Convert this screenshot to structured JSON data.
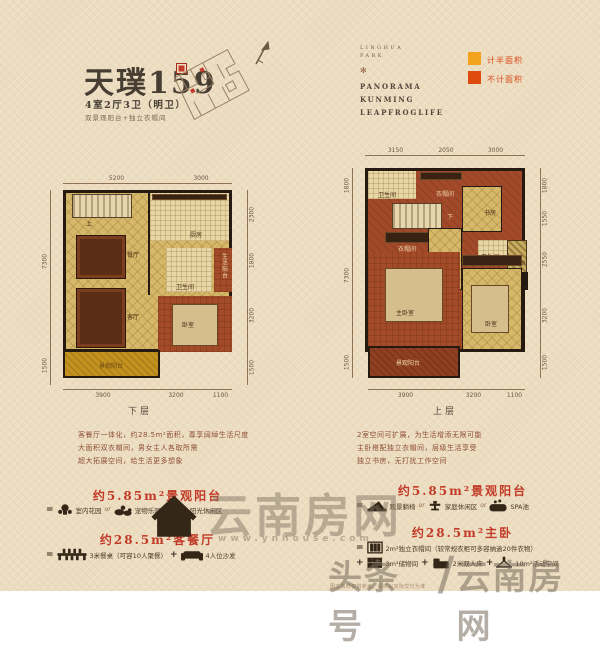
{
  "header": {
    "title": "天璞159",
    "subtitle": "4室2厅3卫（明卫）",
    "tagline": "双景观阳台+独立衣帽间",
    "brand_top1": "LINGHUA",
    "brand_top2": "PARK",
    "brand_lines": [
      "PANORAMA",
      "KUNMING",
      "LEAPFROGLIFE"
    ],
    "legend": [
      {
        "label": "计半面积",
        "color": "#f3a21d"
      },
      {
        "label": "不计面积",
        "color": "#de4a0e"
      }
    ]
  },
  "plans": [
    {
      "floor": "下层",
      "dims_top": [
        "5200",
        "3000"
      ],
      "dims_left": [
        "7300",
        "1500"
      ],
      "dims_right": [
        "2300",
        "1800",
        "3200",
        "1500"
      ],
      "dims_bottom": [
        "3900",
        "3200",
        "1100"
      ],
      "rooms": {
        "stair": "上",
        "dining": "餐厅",
        "kitchen": "厨房",
        "bath": "卫生间",
        "service_balcony": "生活阳台",
        "living": "客厅",
        "bedroom": "卧室",
        "view_balcony": "景观阳台"
      }
    },
    {
      "floor": "上层",
      "dims_top": [
        "3150",
        "2050",
        "3000"
      ],
      "dims_left": [
        "1800",
        "7300",
        "1500"
      ],
      "dims_right": [
        "1800",
        "1550",
        "2550",
        "3200",
        "1500"
      ],
      "dims_bottom": [
        "3900",
        "3200",
        "1100"
      ],
      "rooms": {
        "bath1": "卫生间",
        "cloak1": "衣帽间",
        "study": "书房",
        "stair": "下",
        "cloak2": "衣帽间",
        "bath2": "卫生间",
        "slab": "结构板",
        "master": "主卧室",
        "bedroom": "卧室",
        "view_balcony": "景观阳台"
      }
    }
  ],
  "descriptions": {
    "lower": [
      "客餐厅一体化，约28.5m²面积，尊享阔绰生活尺度",
      "大面积双衣帽间，男女主人各取所需",
      "超大拓展空间，给生活更多想象"
    ],
    "upper": [
      "2室空间可扩展，为生活增添无限可能",
      "主卧搭配独立衣帽间，层级生活享受",
      "独立书房，无打扰工作空间"
    ]
  },
  "features": {
    "left": {
      "heading1": "约5.85m²景观阳台",
      "row1": {
        "eq": "=",
        "item1": "室内花园",
        "sep1": "or",
        "item2": "宠物乐园",
        "sep2": "or",
        "item3": "阳光休闲区"
      },
      "heading2": "约28.5m²客餐厅",
      "row2": {
        "eq": "=",
        "item1": "3米餐桌（可容10人聚餐）",
        "sep1": "+",
        "item2": "4人位沙发"
      }
    },
    "right": {
      "heading1": "约5.85m²景观阳台",
      "row1": {
        "eq": "=",
        "item1": "观景躺椅",
        "sep1": "or",
        "item2": "家庭休闲区",
        "sep2": "or",
        "item3": "SPA池"
      },
      "heading2": "约28.5m²主卧",
      "row2": {
        "eq": "=",
        "item1": "2m²独立衣帽间（较常规衣柜可多容纳逾20件衣物）"
      },
      "row3": {
        "eq": "+",
        "item1": "3m²储物间",
        "sep1": "+",
        "item2": "2米双人床",
        "sep2": "+",
        "item3": "10m²活动空间"
      }
    }
  },
  "watermarks": {
    "center_text": "云南房网",
    "center_url": "www.ynhouse.com",
    "corner_left": "头条号",
    "corner_slash": "/",
    "corner_right": "云南房网"
  },
  "fine_print": "图文资料仅供参考，最终以实际交付为准"
}
